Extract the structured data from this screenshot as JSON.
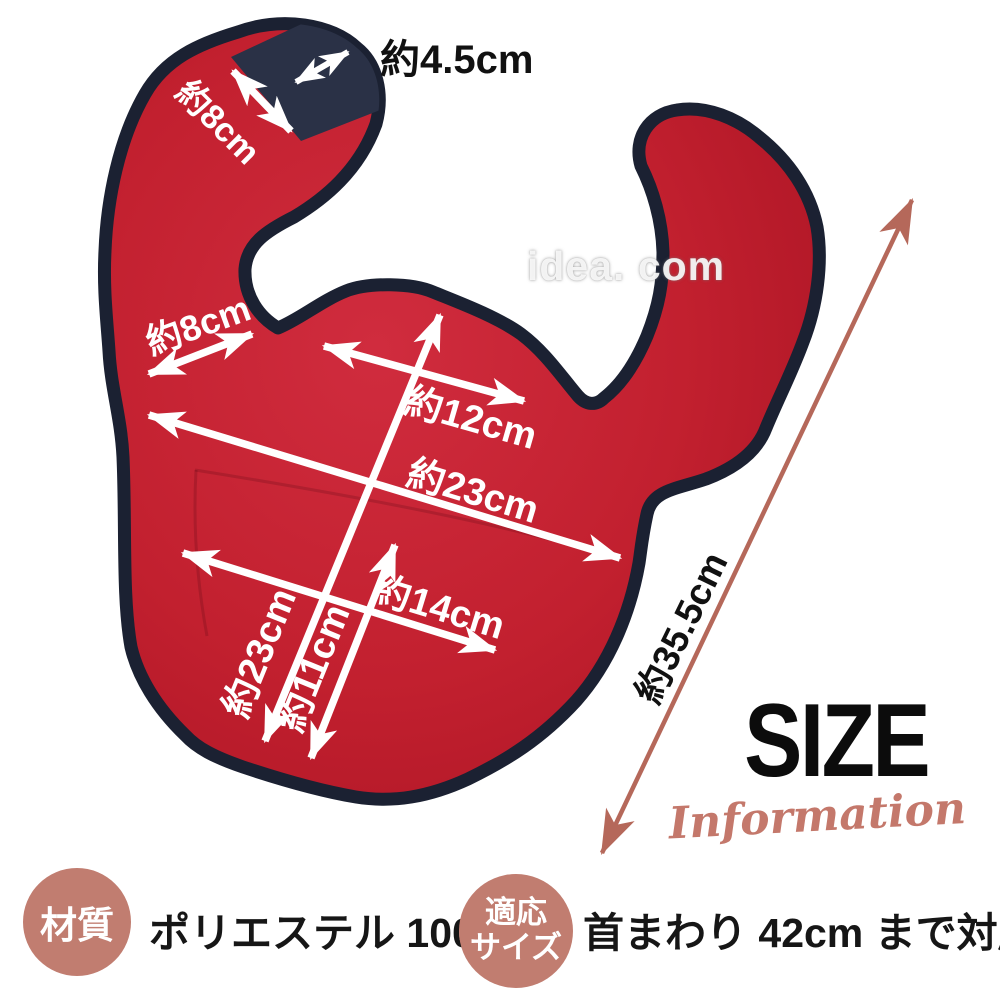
{
  "product": {
    "watermark": "idea. com",
    "description": "baby bib dimension diagram"
  },
  "title": {
    "main": "SIZE",
    "script": "Information"
  },
  "dimensions": {
    "velcro_width": "約4.5cm",
    "strap_width": "約8cm",
    "shoulder_width": "約8cm",
    "chest_width": "約12cm",
    "body_width": "約23cm",
    "pocket_width": "約14cm",
    "body_height": "約23cm",
    "pocket_height": "約11cm",
    "total_length": "約35.5cm"
  },
  "specs": {
    "material_badge": "材質",
    "material_value": "ポリエステル 100%",
    "fit_badge_line1": "適応",
    "fit_badge_line2": "サイズ",
    "fit_value": "首まわり 42cm まで対応"
  },
  "colors": {
    "bib_red": "#c2202f",
    "bib_red_dark": "#ab1424",
    "border_navy": "#1b2132",
    "velcro_navy": "#2a3146",
    "accent_salmon": "#c17d70",
    "arrow_salmon": "#b5685a",
    "script_salmon": "#c4786b",
    "dimension_white": "#ffffff",
    "title_black": "#0c0c0c",
    "watermark_gray": "#d8d8d8"
  }
}
